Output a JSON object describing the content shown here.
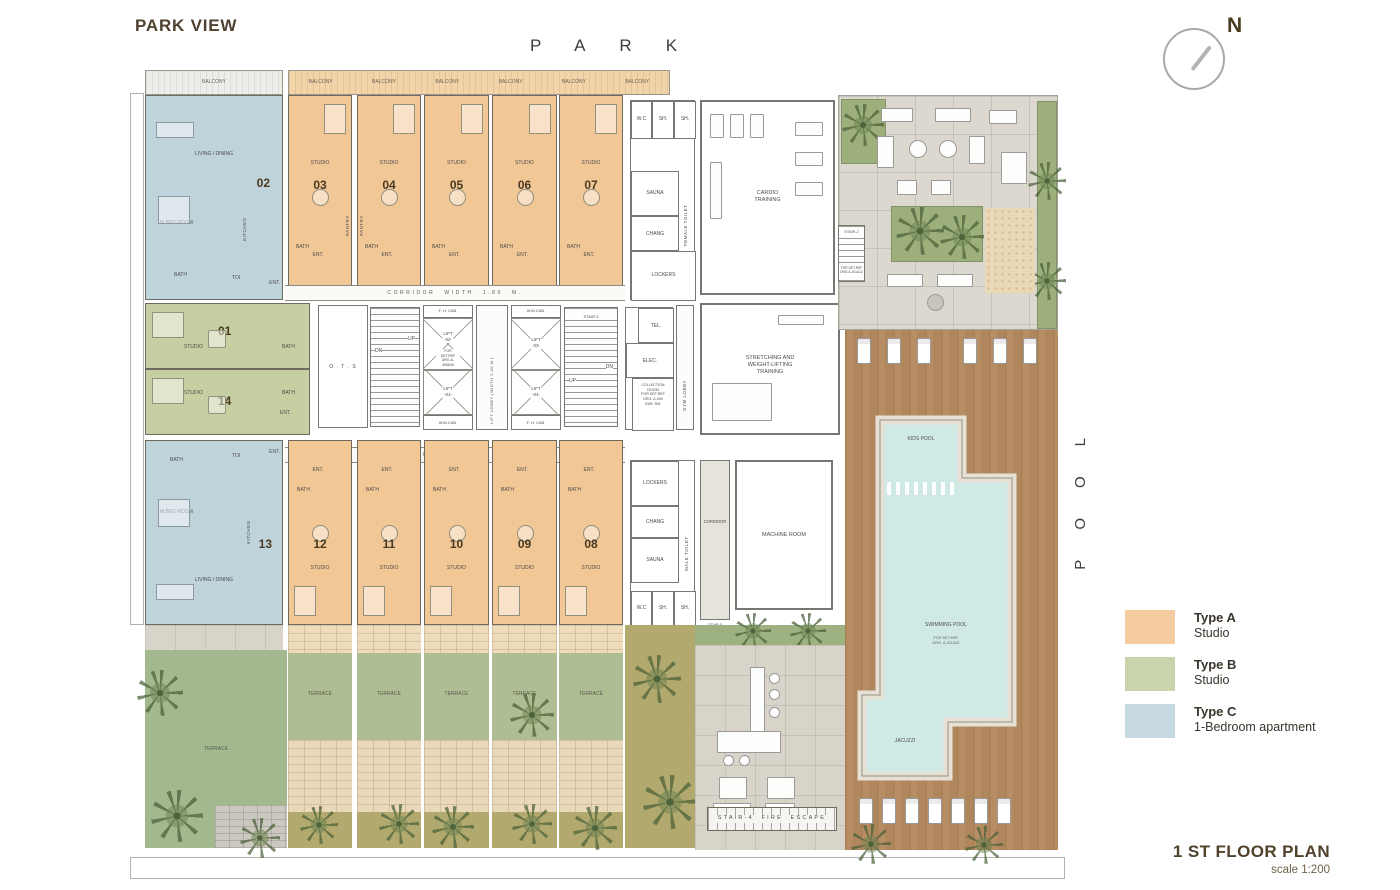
{
  "header": {
    "title": "PARK VIEW",
    "park": "PARK",
    "north": "N"
  },
  "footer": {
    "title": "1 ST FLOOR PLAN",
    "scale": "scale 1:200"
  },
  "side_label": {
    "pool": "POOL"
  },
  "legend": [
    {
      "name": "Type A",
      "desc": "Studio",
      "color": "#f5cba0"
    },
    {
      "name": "Type B",
      "desc": "Studio",
      "color": "#cad4aa"
    },
    {
      "name": "Type C",
      "desc": "1-Bedroom apartment",
      "color": "#c7d9e1"
    }
  ],
  "units": {
    "top_a": [
      "03",
      "04",
      "05",
      "06",
      "07"
    ],
    "bottom_a": [
      "12",
      "11",
      "10",
      "09",
      "08"
    ],
    "b": [
      "01",
      "14"
    ],
    "c": [
      "02",
      "13"
    ]
  },
  "labels": {
    "balcony": "BALCONY",
    "terrace": "TERRACE",
    "studio": "STUDIO",
    "bath": "BATH",
    "ent": "ENT.",
    "toi": "TOI",
    "kitchen": "KITCHEN",
    "pantry": "PANTRY",
    "living": "LIVING / DINING",
    "bedroom": "M.BED ROOM",
    "corridor_width": "CORRIDOR WIDTH 1.80 M.",
    "lift_lobby": "LIFT LOBBY (WIDTH 2.40 M.)",
    "ots": "O . T . S",
    "fhcab": "F. H. CAB.",
    "wmcab": "W.M.CAB.",
    "lift01": "LIFT\n-01-",
    "lift02": "LIFT\n-02-",
    "lift03": "LIFT\n-03-",
    "lift04": "LIFT\n-04-",
    "det405": "FOR DET.REF\nDRG.A-405&06",
    "det411": "FOR DET.REF\nDRG.A-411&12",
    "collection": "COLLECTION\nROOM\nFOR DET.REF\nDRG. A-409\nGAR. RM.",
    "tel": "TEL.",
    "elec": "ELEC.",
    "gym_lobby": "GYM LOBBY",
    "wc": "W.C",
    "sh": "SH.",
    "sauna": "SAUNA",
    "chang": "CHANG",
    "lockers": "LOCKERS",
    "female_toilet": "FEMALE TOILET",
    "male_toilet": "MALE TOILET",
    "corridor": "CORRIDOR",
    "cardio": "CARDIO\nTRAINING",
    "stretching": "STRETCHING AND\nWEIGHT-LIFTING\nTRAINING",
    "machine": "MACHINE ROOM",
    "stair2": "STAIR-2",
    "stair3": "STAIR-3",
    "stair4": "STAIR-4 FIRE ESCAPE",
    "stair5": "STAIR-5\nFOR DET.REF\nDRG.A-411&12",
    "up": "UP",
    "dn": "DN",
    "kids_pool": "KIDS POOL",
    "swimming_pool": "SWIMMING POOL",
    "pool_det": "FOR DET.REF\nDRG. A-411&12",
    "jacuzzi": "JACUZZI"
  },
  "colors": {
    "type_a": "#f1c795",
    "type_b": "#c6cfa2",
    "type_c": "#bfd3da",
    "water": "#cfe9e5",
    "wood_deck": "#b18a60",
    "accent_text": "#4f4130"
  }
}
